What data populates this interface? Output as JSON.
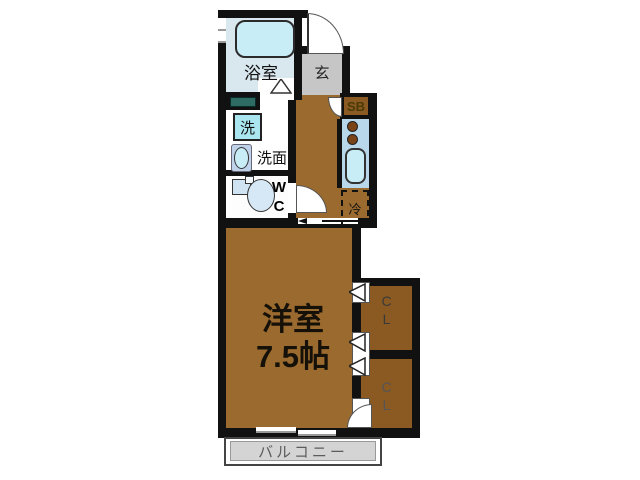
{
  "plan": {
    "type": "floor-plan",
    "rooms": {
      "bathroom": {
        "label": "浴室"
      },
      "entrance": {
        "label": "玄"
      },
      "shoe_box": {
        "label": "SB"
      },
      "laundry": {
        "label": "洗"
      },
      "vanity": {
        "label": "洗面"
      },
      "toilet": {
        "label_line1": "W",
        "label_line2": "C"
      },
      "refrigerator": {
        "label": "冷"
      },
      "western_room": {
        "label": "洋室",
        "size": "7.5帖"
      },
      "closet_upper": {
        "label_line1": "C",
        "label_line2": "L"
      },
      "closet_lower": {
        "label_line1": "C",
        "label_line2": "L"
      },
      "balcony": {
        "label": "バルコニー"
      }
    },
    "colors": {
      "wall": "#111111",
      "floor_brown": "#9a6a2e",
      "closet_brown": "#8a5a22",
      "bath_blue": "#d9e7ee",
      "fixture_blue": "#c9edf6",
      "kitchen_blue": "#b9d7eb",
      "laundry_blue": "#aae6f0",
      "genkan_gray": "#c6c6c6",
      "balcony_gray": "#d4d4d4",
      "pan_teal": "#2e6b63",
      "burner_brown": "#7a4418",
      "sb_text": "#4a3a06"
    }
  }
}
